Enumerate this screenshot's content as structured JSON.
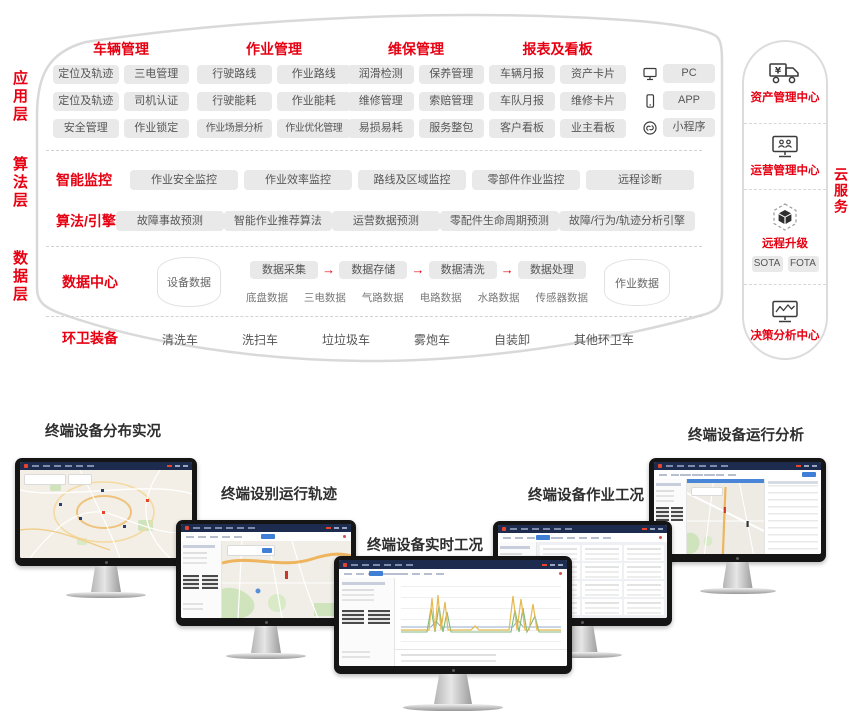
{
  "colors": {
    "accent": "#e60012",
    "chip_bg": "#e9e9e9",
    "chip_text": "#565656",
    "topbar_navy": "#1d2b4f",
    "active_blue": "#3f7fd6",
    "panel_border": "#d9d9d9"
  },
  "left_labels": [
    "应用层",
    "算法层",
    "数据层"
  ],
  "app_layer": {
    "groups": [
      {
        "title": "车辆管理",
        "chips": [
          [
            "定位及轨迹",
            "三电管理"
          ],
          [
            "定位及轨迹",
            "司机认证"
          ],
          [
            "安全管理",
            "作业锁定"
          ]
        ]
      },
      {
        "title": "作业管理",
        "chips": [
          [
            "行驶路线",
            "作业路线"
          ],
          [
            "行驶能耗",
            "作业能耗"
          ],
          [
            "作业场景分析",
            "作业优化管理"
          ]
        ]
      },
      {
        "title": "维保管理",
        "chips": [
          [
            "润滑检测",
            "保养管理"
          ],
          [
            "维修管理",
            "索赔管理"
          ],
          [
            "易损易耗",
            "服务整包"
          ]
        ]
      },
      {
        "title": "报表及看板",
        "chips": [
          [
            "车辆月报",
            "资产卡片"
          ],
          [
            "车队月报",
            "维修卡片"
          ],
          [
            "客户看板",
            "业主看板"
          ]
        ]
      }
    ],
    "platforms": [
      {
        "icon": "desktop-icon",
        "label": "PC"
      },
      {
        "icon": "smartphone-icon",
        "label": "APP"
      },
      {
        "icon": "miniprogram-icon",
        "label": "小程序"
      }
    ]
  },
  "algo_layer": {
    "rows": [
      {
        "title": "智能监控",
        "chips": [
          "作业安全监控",
          "作业效率监控",
          "路线及区域监控",
          "零部件作业监控",
          "远程诊断"
        ]
      },
      {
        "title": "算法/引擎",
        "chips": [
          "故障事故预测",
          "智能作业推荐算法",
          "运营数据预测",
          "零配件生命周期预测",
          "故障/行为/轨迹分析引擎"
        ]
      }
    ]
  },
  "data_layer": {
    "title": "数据中心",
    "device_db": "设备数据",
    "pipeline": [
      "数据采集",
      "数据存储",
      "数据清洗",
      "数据处理"
    ],
    "arrow": "→",
    "sources": [
      "底盘数据",
      "三电数据",
      "气路数据",
      "电路数据",
      "水路数据",
      "传感器数据"
    ],
    "job_db": "作业数据"
  },
  "equipment": {
    "title": "环卫装备",
    "items": [
      "清洗车",
      "洗扫车",
      "垃垃圾车",
      "雾炮车",
      "自装卸",
      "其他环卫车"
    ]
  },
  "cloud": {
    "side_label": "云服务",
    "sections": [
      {
        "icon": "asset-truck-icon",
        "label": "资产管理中心"
      },
      {
        "icon": "operation-monitor-icon",
        "label": "运营管理中心"
      },
      {
        "icon": "ota-cube-icon",
        "label": "远程升级",
        "chips": [
          "SOTA",
          "FOTA"
        ]
      },
      {
        "icon": "analytics-monitor-icon",
        "label": "决策分析中心"
      }
    ]
  },
  "monitors": [
    {
      "caption": "终端设备分布实况",
      "screen": "distribution-map-dashboard"
    },
    {
      "caption": "终端设别运行轨迹",
      "screen": "trajectory-map-dashboard"
    },
    {
      "caption": "终端设备实时工况",
      "screen": "realtime-charts-dashboard"
    },
    {
      "caption": "终端设备作业工况",
      "screen": "work-status-table-dashboard"
    },
    {
      "caption": "终端设备运行分析",
      "screen": "analysis-map-table-dashboard"
    }
  ]
}
